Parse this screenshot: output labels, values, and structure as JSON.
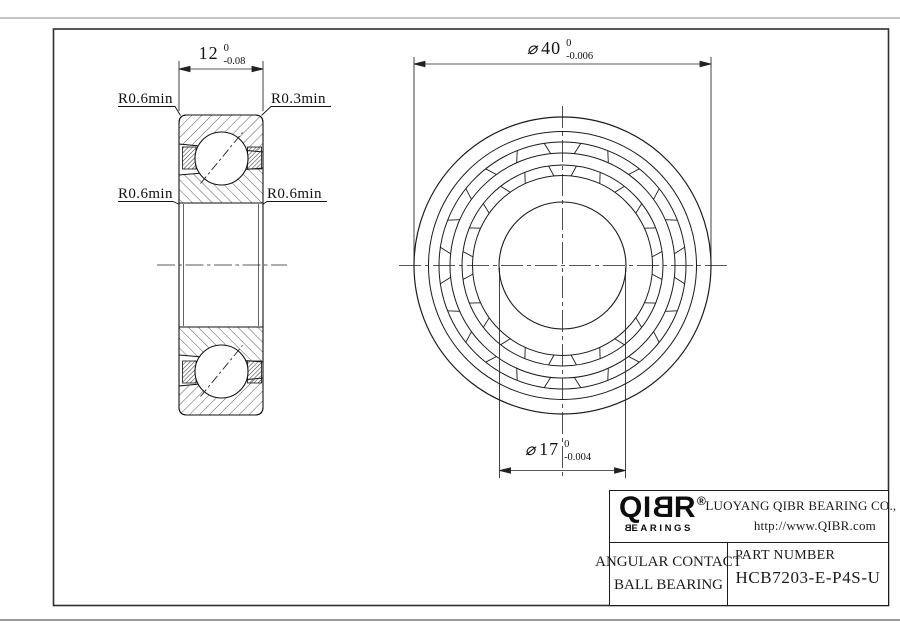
{
  "dimensions": {
    "width": {
      "value": "12",
      "tol_upper": "0",
      "tol_lower": "-0.08"
    },
    "outer_diameter": {
      "symbol": "⌀",
      "value": "40",
      "tol_upper": "0",
      "tol_lower": "-0.006"
    },
    "bore_diameter": {
      "symbol": "⌀",
      "value": "17",
      "tol_upper": "0",
      "tol_lower": "-0.004"
    }
  },
  "radius_labels": {
    "top_left": "R0.6min",
    "top_right": "R0.3min",
    "mid_left": "R0.6min",
    "mid_right": "R0.6min"
  },
  "title_block": {
    "logo": {
      "q": "Q",
      "i": "I",
      "b": "B",
      "r": "R",
      "registered": "®",
      "sub_first": "B",
      "sub_rest": "EARINGS"
    },
    "company": "LUOYANG QIBR BEARING CO., LTD",
    "website": "http://www.QIBR.com",
    "product_line1": "ANGULAR CONTACT",
    "product_line2": "BALL BEARING",
    "part_number_label": "PART NUMBER",
    "part_number": "HCB7203-E-P4S-U"
  },
  "colors": {
    "line": "#1b1b1b",
    "page_edge": "#b0b0b0",
    "hatch": "#4a4a4a"
  }
}
